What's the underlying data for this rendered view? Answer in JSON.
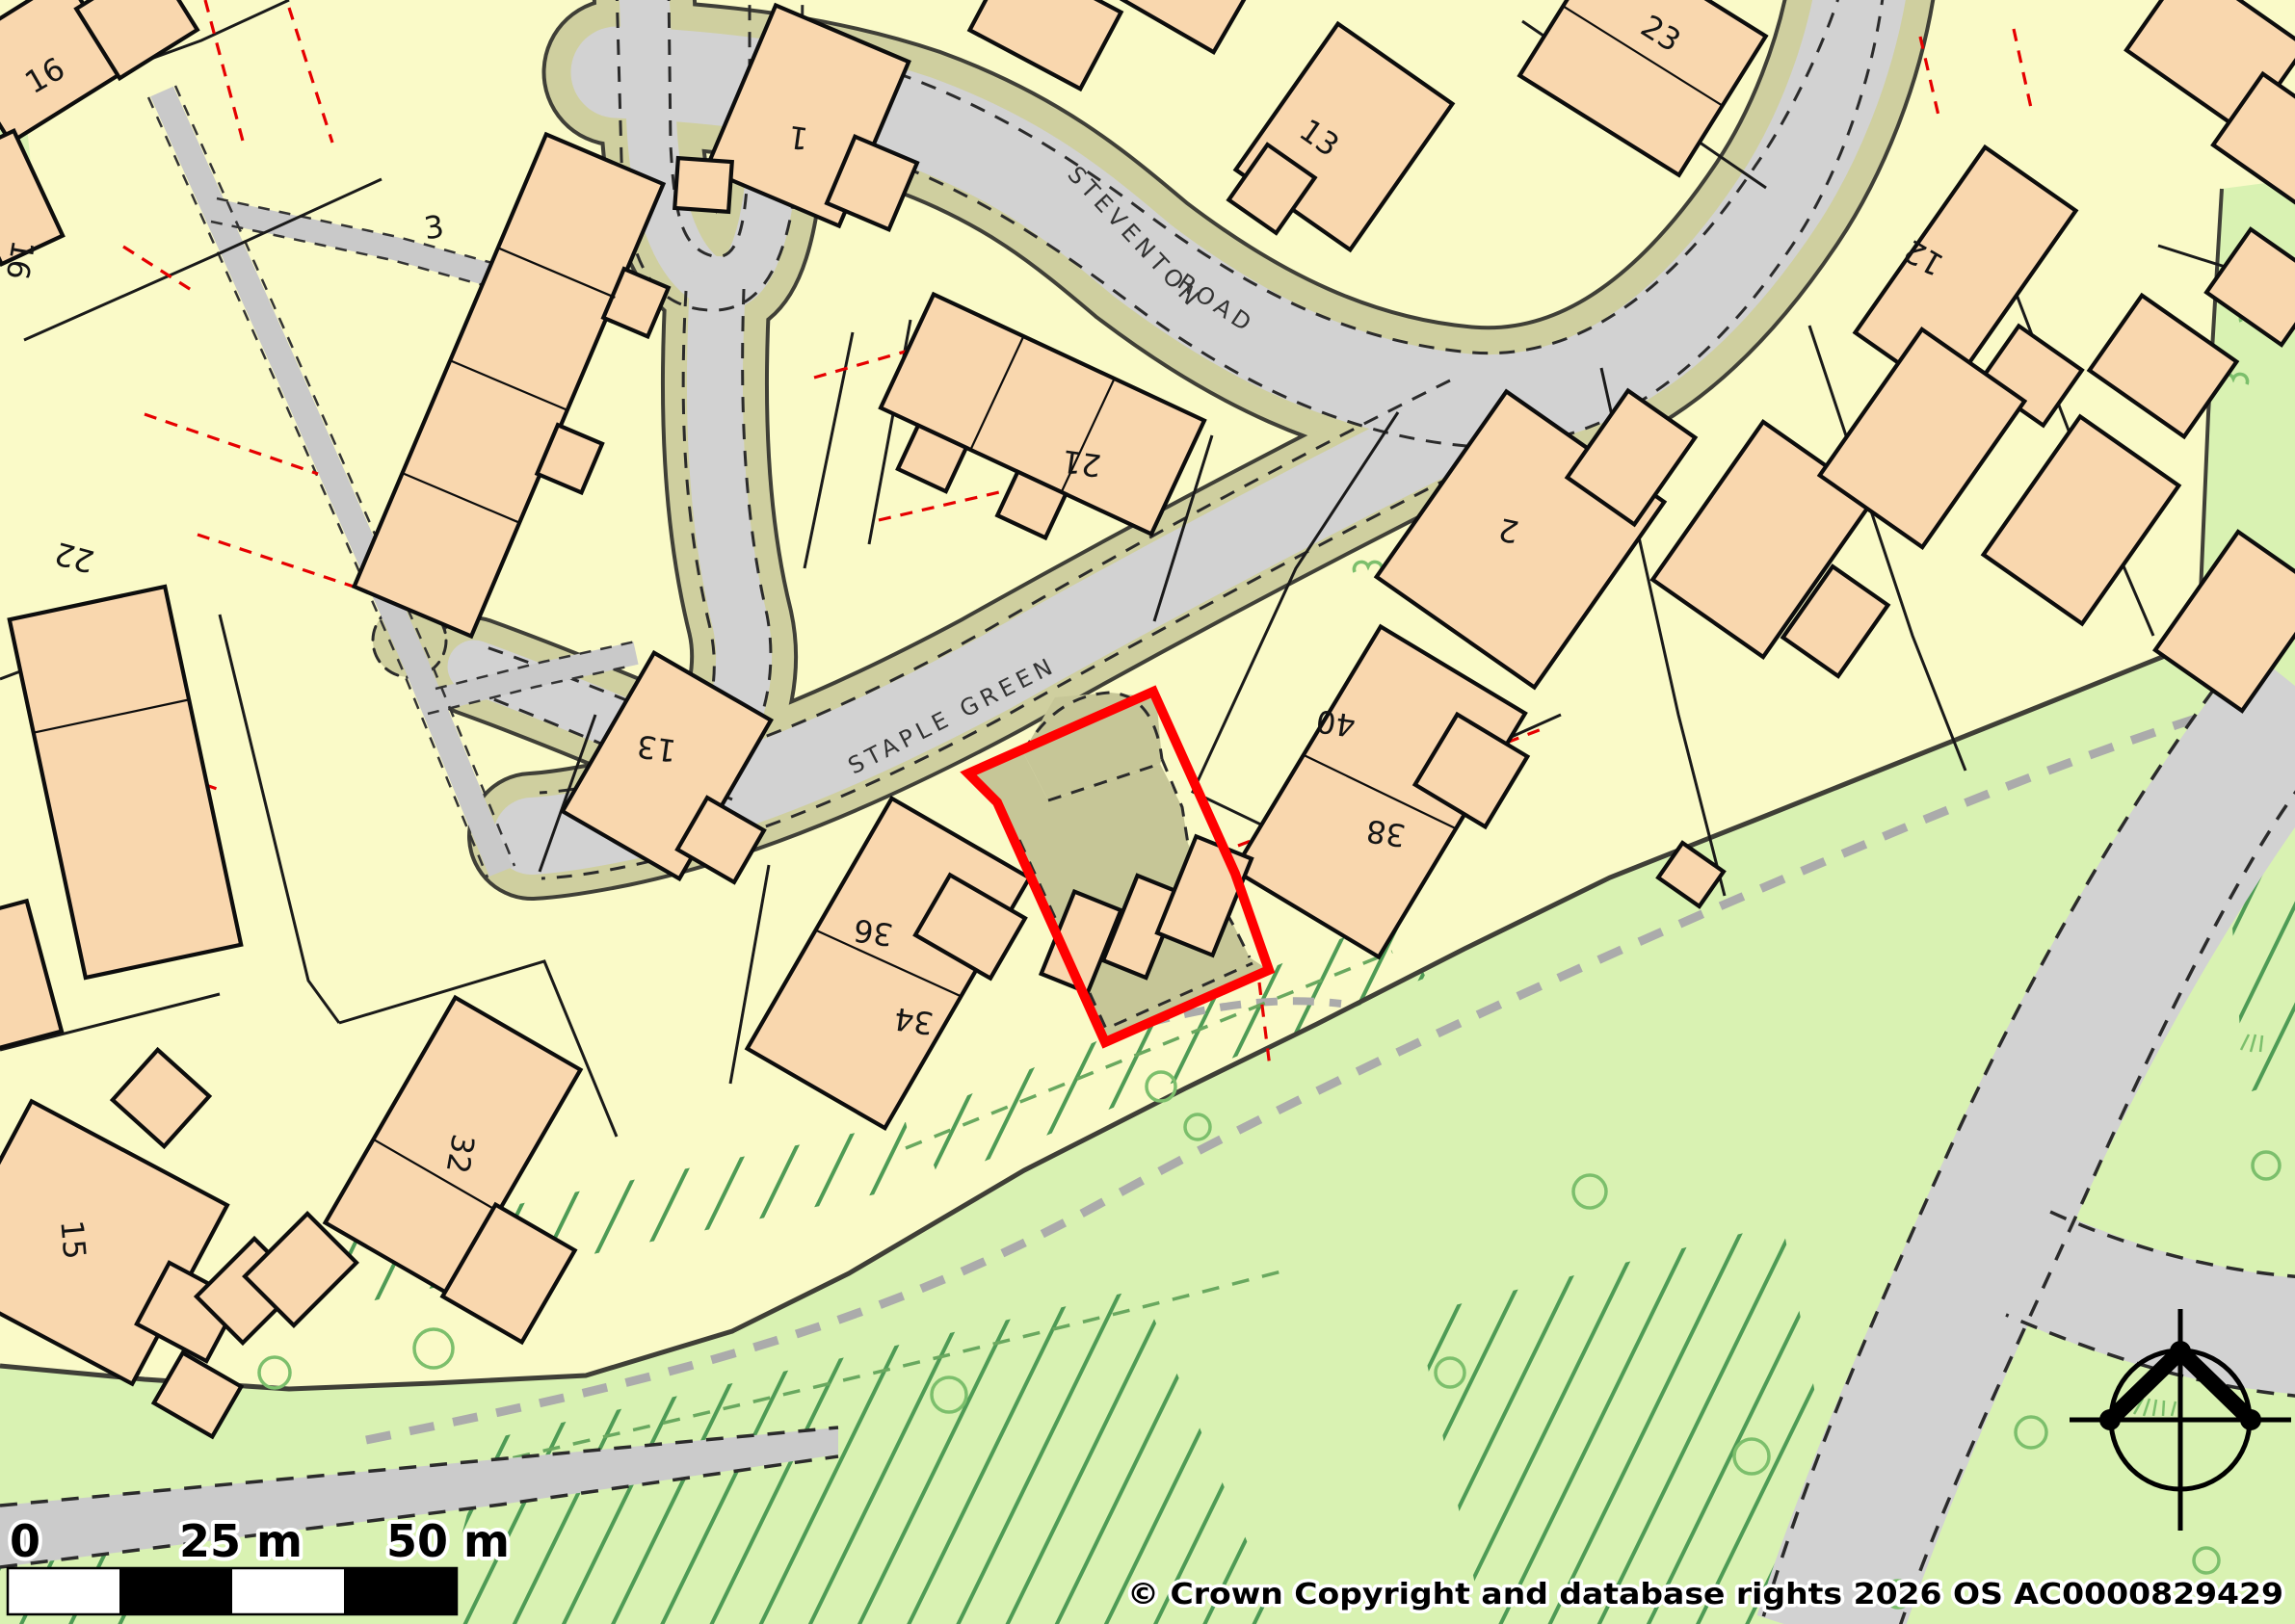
{
  "map": {
    "attribution": "© Crown Copyright and database rights 2026 OS AC0000829429",
    "scale_bar": {
      "start_label": "0",
      "mid_label": "25 m",
      "end_label": "50 m"
    },
    "road_labels": {
      "steventon_word1": "STEVENTON",
      "steventon_word2": "ROAD",
      "staple_green": "STAPLE GREEN"
    },
    "house_numbers": {
      "h16": "16",
      "h16b": "16",
      "h3": "3",
      "h1": "1",
      "h13_top": "13",
      "h23": "23",
      "h12": "12",
      "h21": "21",
      "h22": "22",
      "h2": "2",
      "h13_sg": "13",
      "h40": "40",
      "h38": "38",
      "h36": "36",
      "h34": "34",
      "h32": "32",
      "h15": "15"
    },
    "icons": {
      "north_compass": "north-compass-icon"
    },
    "colors": {
      "parcel": "#fafac8",
      "building": "#f9d7ae",
      "road": "#d2d2d2",
      "verge": "#cfcf9f",
      "casing": "#3f3f37",
      "greenspace": "#d9f2b2",
      "hatch_green": "#4e9b55",
      "tree_green": "#7cbf6c",
      "site_interior": "#c6c697",
      "site_boundary_red": "#ff0000",
      "parcel_dash_red": "#e60000"
    }
  }
}
